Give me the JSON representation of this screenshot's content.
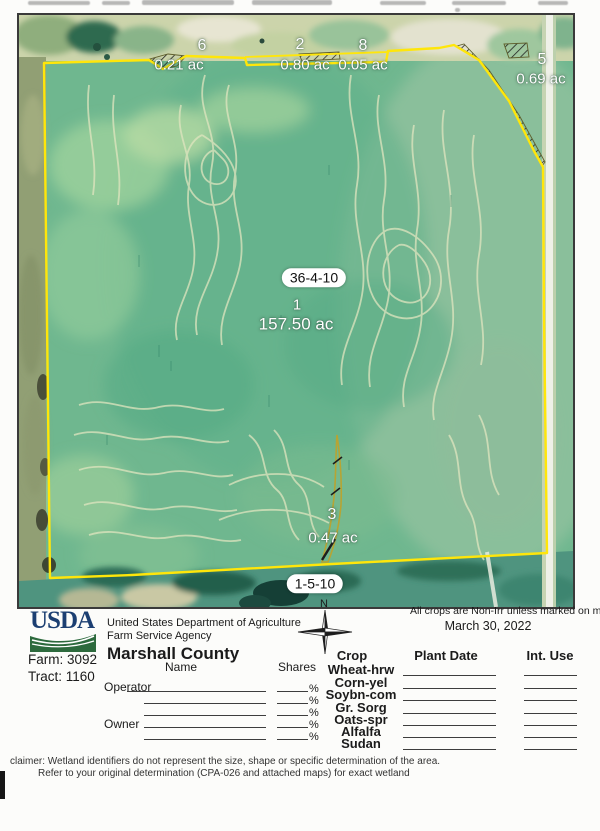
{
  "colors": {
    "boundary_yellow": "#ffe60a",
    "usda_blue": "#1c3f72",
    "usda_green": "#2d6a3d"
  },
  "map": {
    "fields": [
      {
        "number": "6",
        "acres": "0.21 ac"
      },
      {
        "number": "2",
        "acres": "0.80 ac"
      },
      {
        "number": "8",
        "acres": "0.05 ac"
      },
      {
        "number": "5",
        "acres": "0.69 ac"
      },
      {
        "number": "1",
        "acres": "157.50 ac"
      },
      {
        "number": "3",
        "acres": "0.47 ac"
      }
    ],
    "section_labels": [
      "36-4-10",
      "1-5-10"
    ]
  },
  "footer": {
    "usda_logo_text": "USDA",
    "agency_line1": "United States Department of Agriculture",
    "agency_line2": "Farm Service Agency",
    "county": "Marshall County",
    "farm": "Farm: 3092",
    "tract": "Tract: 1160",
    "non_irr_note": "All crops are Non-Irr unless marked on map",
    "date": "March 30, 2022",
    "compass_n": "N",
    "parties": {
      "name_header": "Name",
      "shares_header": "Shares",
      "operator_label": "Operator",
      "owner_label": "Owner",
      "percent": "%"
    },
    "crop_table": {
      "crop_header": "Crop",
      "plant_date_header": "Plant Date",
      "int_use_header": "Int. Use",
      "crops": [
        "Wheat-hrw",
        "Corn-yel",
        "Soybn-com",
        "Gr. Sorg",
        "Oats-spr",
        "Alfalfa",
        "Sudan"
      ]
    },
    "disclaimer_line1": "claimer: Wetland identifiers do not represent the size, shape or specific determination of the area.",
    "disclaimer_line2": "Refer to your original determination (CPA-026 and attached maps) for exact wetland"
  }
}
